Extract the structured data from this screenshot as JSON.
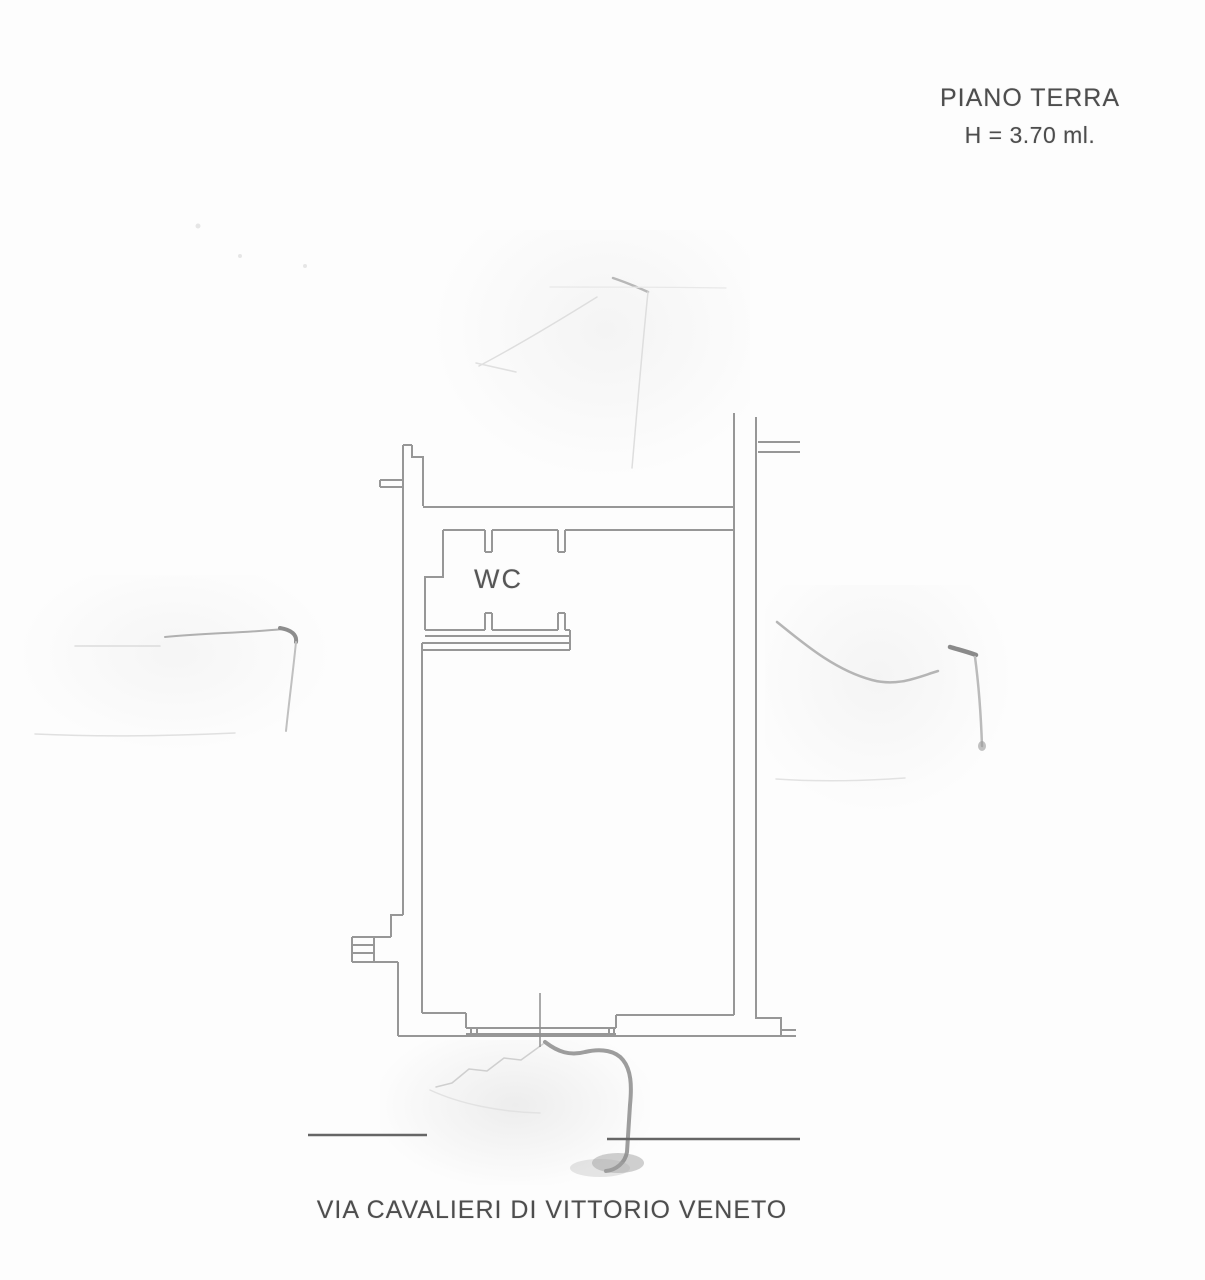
{
  "header": {
    "floor_title": "PIANO TERRA",
    "floor_height": "H = 3.70 ml."
  },
  "floor_plan": {
    "wc_label": "WC"
  },
  "street": {
    "name": "VIA CAVALIERI DI VITTORIO VENETO"
  },
  "colors": {
    "plan_line": "#979797",
    "text": "#4d4d4d",
    "street_line": "#666666",
    "background": "#fdfdfd"
  }
}
